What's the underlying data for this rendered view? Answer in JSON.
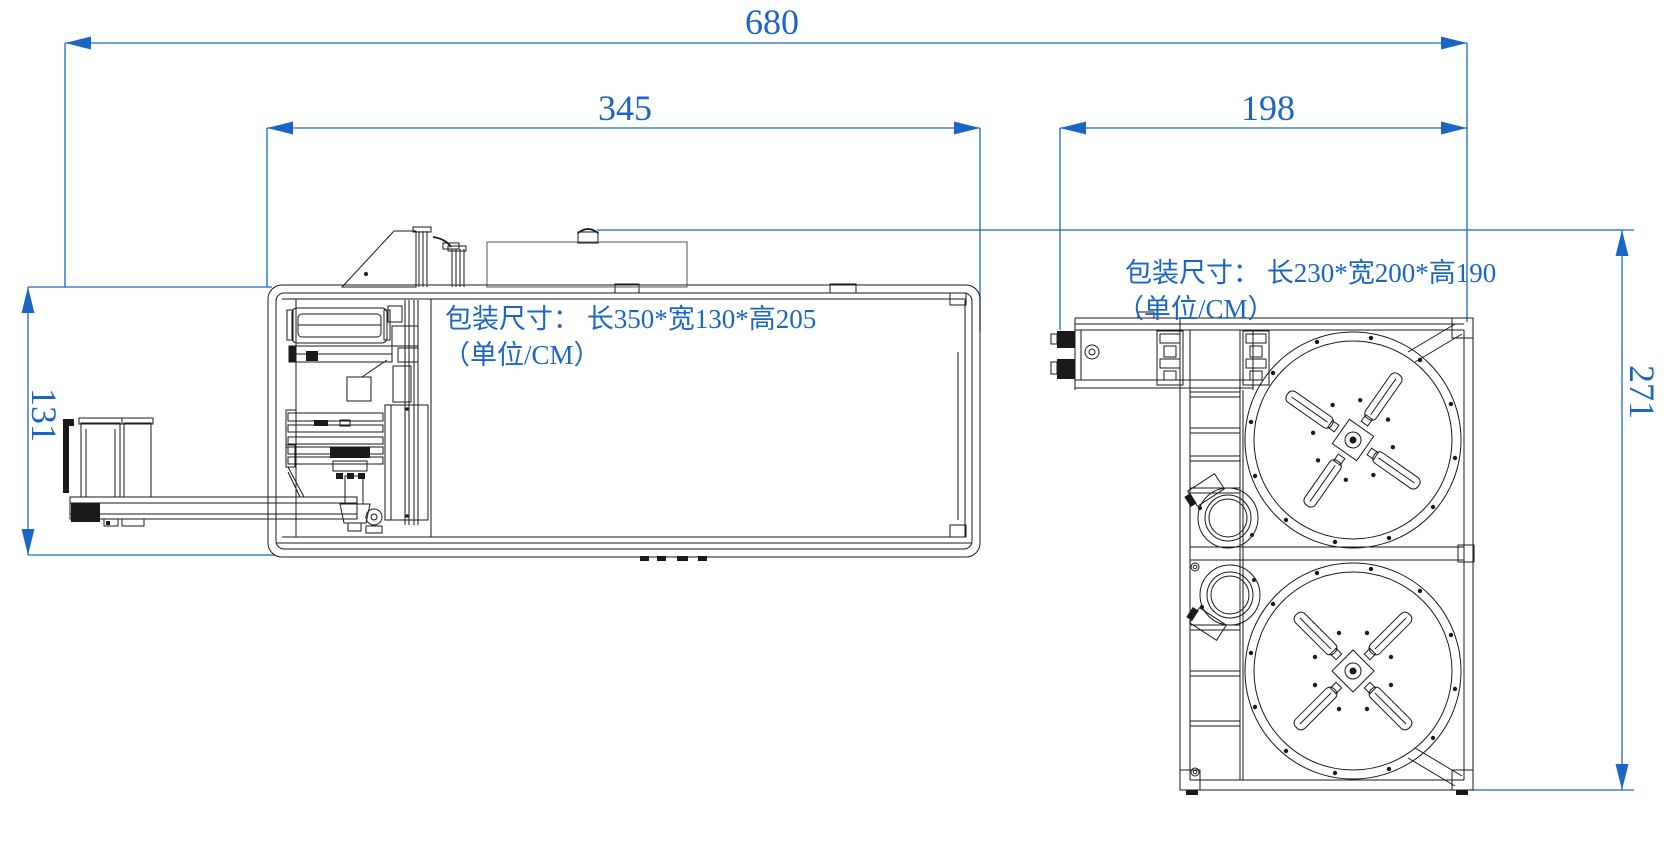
{
  "drawing": {
    "kind": "machine layout plan",
    "background": "#ffffff"
  },
  "colors": {
    "dimension_blue": "#1b66c4",
    "linework_black": "#1a1a1a"
  },
  "dimensions": {
    "overall_length": {
      "value": "680",
      "orientation": "horizontal"
    },
    "left_machine_length": {
      "value": "345",
      "orientation": "horizontal"
    },
    "right_machine_length": {
      "value": "198",
      "orientation": "horizontal"
    },
    "left_machine_depth": {
      "value": "131",
      "orientation": "vertical"
    },
    "right_machine_depth": {
      "value": "271",
      "orientation": "vertical"
    }
  },
  "labels": {
    "left_packing": {
      "line1": "包装尺寸： 长350*宽130*高205",
      "line2": "（单位/CM）"
    },
    "right_packing": {
      "line1": "包装尺寸： 长230*宽200*高190",
      "line2": "（单位/CM）"
    }
  }
}
